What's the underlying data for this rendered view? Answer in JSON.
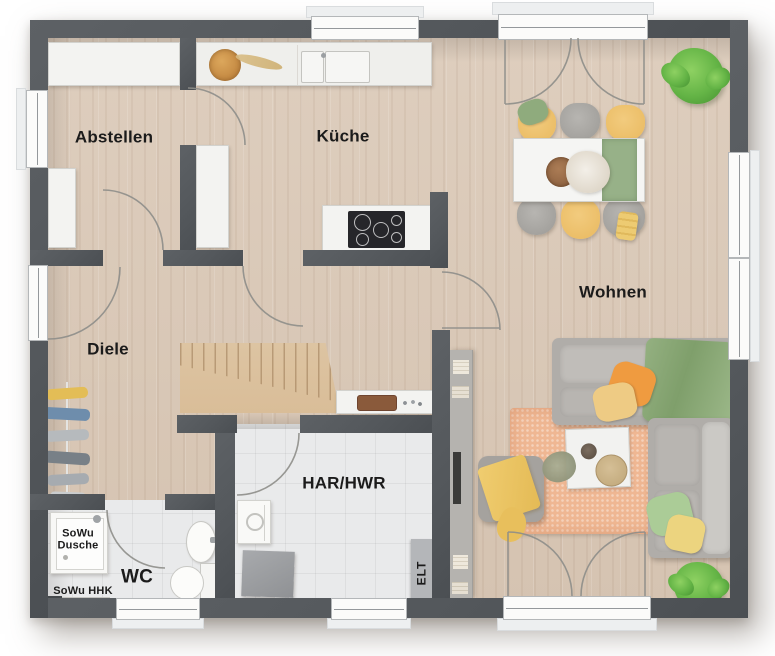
{
  "plan": {
    "type": "floor-plan",
    "rooms": {
      "abstellen": {
        "label": "Abstellen"
      },
      "kueche": {
        "label": "Küche"
      },
      "wohnen": {
        "label": "Wohnen"
      },
      "diele": {
        "label": "Diele"
      },
      "wc": {
        "label": "WC"
      },
      "har": {
        "label": "HAR/HWR"
      }
    },
    "fixtures": {
      "shower_label": "SoWu\nDusche",
      "heater_label": "SoWu HHK",
      "electrical_label": "ELT"
    }
  },
  "colors": {
    "wall": "#54585c",
    "wood_floor": "#dbcaba",
    "tile_floor": "#e9eaeb",
    "stairs_wood": "#d9bd98",
    "sofa_gray": "#b0ada9",
    "accent_yellow": "#e9b95f",
    "accent_orange": "#ef9b40",
    "accent_green": "#8fab7d",
    "rug_peach": "#efb793",
    "plant_green": "#64b446",
    "label_text": "#1b1b1b"
  }
}
